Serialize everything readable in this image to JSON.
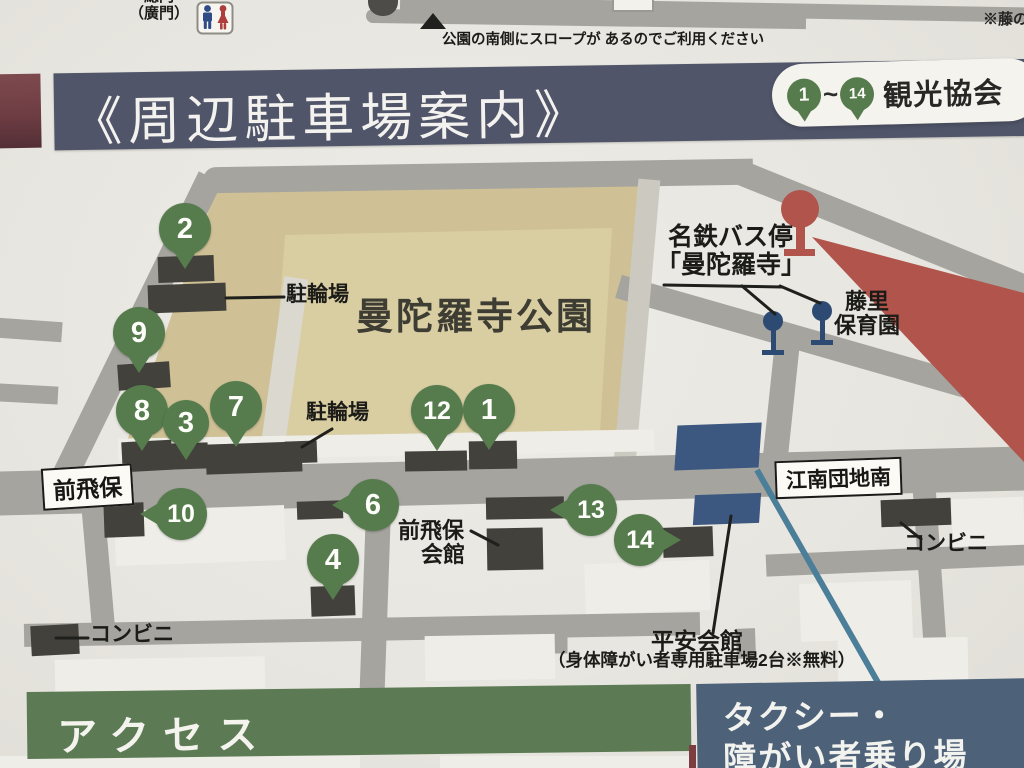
{
  "top": {
    "gate_line1": "総門",
    "gate_line2": "（廣門）",
    "slope_note": "公園の南側にスロープが あるのでご利用ください",
    "corner_note": "※藤の"
  },
  "header": {
    "title": "《周辺駐車場案内》",
    "band_color": "#505569",
    "accent_stripe_color": "#6e3d43",
    "legend": {
      "from": "1",
      "tilde": "~",
      "to": "14",
      "label": "観光協会"
    }
  },
  "colors": {
    "road": "#a5a49f",
    "park_outer": "#cfc195",
    "park_inner": "#d9cda2",
    "parking_lot": "#42413b",
    "pin_green": "#567c4e",
    "bus_stop_blue": "#2c4a72",
    "heian_blue": "#3c5880",
    "marker_red": "#b0544c",
    "water_line": "#4b7e98"
  },
  "map": {
    "park_name": "曼陀羅寺公園",
    "park_shape": {
      "outer": [
        [
          216,
          190
        ],
        [
          650,
          182
        ],
        [
          634,
          440
        ],
        [
          126,
          444
        ]
      ],
      "inner": [
        [
          285,
          235
        ],
        [
          612,
          228
        ],
        [
          600,
          432
        ],
        [
          270,
          436
        ]
      ]
    },
    "roads": [
      {
        "cx": 713,
        "cy": 9,
        "l": 626,
        "w": 15,
        "a": 1
      },
      {
        "cx": 586,
        "cy": 19,
        "l": 440,
        "w": 14,
        "a": 0.8,
        "cap": 1
      },
      {
        "cx": 478,
        "cy": 176,
        "l": 550,
        "w": 26,
        "a": -0.9,
        "cap": 1
      },
      {
        "cx": 886,
        "cy": 231,
        "l": 315,
        "w": 25,
        "a": 22
      },
      {
        "cx": 830,
        "cy": 347,
        "l": 440,
        "w": 24,
        "a": 16
      },
      {
        "cx": 637,
        "cy": 321,
        "l": 284,
        "w": 22,
        "a": 95,
        "c": "#ccc9c1"
      },
      {
        "cx": 132,
        "cy": 338,
        "l": 358,
        "w": 26,
        "a": 116
      },
      {
        "cx": 30,
        "cy": 330,
        "l": 64,
        "w": 20,
        "a": 4
      },
      {
        "cx": 28,
        "cy": 394,
        "l": 60,
        "w": 18,
        "a": 3
      },
      {
        "cx": 512,
        "cy": 481,
        "l": 1060,
        "w": 44,
        "a": -1.4
      },
      {
        "cx": 781,
        "cy": 403,
        "l": 128,
        "w": 25,
        "a": 96
      },
      {
        "cx": 98,
        "cy": 570,
        "l": 141,
        "w": 23,
        "a": 85
      },
      {
        "cx": 376,
        "cy": 580,
        "l": 216,
        "w": 25,
        "a": 92
      },
      {
        "cx": 930,
        "cy": 579,
        "l": 223,
        "w": 23,
        "a": 86
      },
      {
        "cx": 362,
        "cy": 629,
        "l": 676,
        "w": 23,
        "a": -1
      },
      {
        "cx": 896,
        "cy": 560,
        "l": 260,
        "w": 22,
        "a": -2.5
      },
      {
        "cx": 558,
        "cy": 640,
        "l": 26,
        "w": 19,
        "a": 90
      },
      {
        "cx": 746,
        "cy": 643,
        "l": 30,
        "w": 19,
        "a": 88
      },
      {
        "cx": 283,
        "cy": 373,
        "l": 192,
        "w": 24,
        "a": 98,
        "c": "#dbd8d0"
      }
    ],
    "blocks": [
      [
        115,
        508,
        170,
        55,
        -2
      ],
      [
        585,
        562,
        125,
        50,
        -2
      ],
      [
        800,
        582,
        112,
        58,
        -2
      ],
      [
        952,
        498,
        72,
        48,
        -2
      ],
      [
        838,
        638,
        130,
        45,
        -1
      ],
      [
        425,
        635,
        130,
        45,
        -1
      ],
      [
        55,
        658,
        210,
        32,
        -1
      ],
      [
        118,
        434,
        536,
        22,
        -1
      ],
      [
        0,
        756,
        360,
        12,
        0
      ],
      [
        440,
        756,
        250,
        12,
        0
      ]
    ],
    "parking_rects": [
      [
        158,
        256,
        56,
        26,
        -2
      ],
      [
        148,
        284,
        78,
        28,
        -2
      ],
      [
        118,
        363,
        52,
        26,
        -4
      ],
      [
        122,
        441,
        50,
        30,
        -3
      ],
      [
        170,
        443,
        38,
        26,
        -2
      ],
      [
        206,
        443,
        96,
        30,
        -2
      ],
      [
        285,
        441,
        32,
        22,
        -2
      ],
      [
        405,
        451,
        62,
        20,
        -1
      ],
      [
        469,
        441,
        48,
        28,
        -1
      ],
      [
        104,
        503,
        40,
        34,
        -2
      ],
      [
        297,
        501,
        46,
        18,
        -2
      ],
      [
        311,
        586,
        44,
        30,
        -2
      ],
      [
        486,
        497,
        78,
        22,
        -1
      ],
      [
        487,
        528,
        56,
        42,
        -1
      ],
      [
        663,
        527,
        50,
        30,
        -2
      ],
      [
        881,
        499,
        70,
        27,
        -2
      ],
      [
        31,
        625,
        48,
        30,
        -3
      ]
    ],
    "heian_blocks": [
      [
        676,
        424,
        84,
        45
      ],
      [
        694,
        494,
        66,
        30
      ]
    ],
    "water_line": [
      757,
      470,
      888,
      700
    ],
    "red_wedge": [
      [
        812,
        237
      ],
      [
        1024,
        293
      ],
      [
        1024,
        462
      ]
    ],
    "red_marker": {
      "x": 800,
      "y": 209
    },
    "bus_stops": [
      [
        773,
        321
      ],
      [
        822,
        311
      ]
    ],
    "leader_lines": [
      [
        226,
        298,
        284,
        297
      ],
      [
        332,
        429,
        302,
        447
      ],
      [
        664,
        285,
        782,
        287
      ],
      [
        742,
        286,
        775,
        314
      ],
      [
        780,
        286,
        820,
        303
      ],
      [
        471,
        531,
        498,
        545
      ],
      [
        901,
        523,
        921,
        539
      ],
      [
        56,
        638,
        88,
        638
      ],
      [
        731,
        516,
        713,
        633
      ]
    ],
    "labels": [
      {
        "t": "駐輪場",
        "x": 286,
        "y": 284,
        "fs": 21
      },
      {
        "t": "駐輪場",
        "x": 306,
        "y": 402,
        "fs": 21
      },
      {
        "t": "名鉄バス停",
        "x": 668,
        "y": 224,
        "fs": 25
      },
      {
        "t": "「曼陀羅寺」",
        "x": 656,
        "y": 252,
        "fs": 25
      },
      {
        "t": "藤里",
        "x": 845,
        "y": 290,
        "fs": 22
      },
      {
        "t": "保育園",
        "x": 834,
        "y": 314,
        "fs": 22
      },
      {
        "t": "前飛保",
        "x": 398,
        "y": 519,
        "fs": 22
      },
      {
        "t": "会館",
        "x": 421,
        "y": 543,
        "fs": 22
      },
      {
        "t": "コンビニ",
        "x": 904,
        "y": 533,
        "fs": 21
      },
      {
        "t": "コンビニ",
        "x": 90,
        "y": 624,
        "fs": 21
      },
      {
        "t": "曼陀羅寺公園",
        "x": 356,
        "y": 298,
        "fs": 37,
        "ls": 3,
        "c": "#3e3d33"
      },
      {
        "t": "平安会館",
        "x": 651,
        "y": 629,
        "fs": 23
      },
      {
        "t": "（身体障がい者専用駐車場2台※無料）",
        "x": 548,
        "y": 651,
        "fs": 17.5
      }
    ],
    "intersections": [
      {
        "t": "前飛保",
        "x": 42,
        "y": 466,
        "fs": 23,
        "a": -3.5
      },
      {
        "t": "江南団地南",
        "x": 775,
        "y": 459,
        "fs": 21,
        "a": -2
      }
    ],
    "pins": [
      {
        "n": "2",
        "x": 185,
        "y": 229
      },
      {
        "n": "9",
        "x": 139,
        "y": 333
      },
      {
        "n": "8",
        "x": 142,
        "y": 411
      },
      {
        "n": "3",
        "x": 186,
        "y": 423,
        "r": 23
      },
      {
        "n": "7",
        "x": 236,
        "y": 407
      },
      {
        "n": "12",
        "x": 437,
        "y": 411
      },
      {
        "n": "1",
        "x": 489,
        "y": 410
      },
      {
        "n": "10",
        "x": 181,
        "y": 514,
        "d": "left"
      },
      {
        "n": "6",
        "x": 373,
        "y": 505,
        "d": "left"
      },
      {
        "n": "4",
        "x": 333,
        "y": 560
      },
      {
        "n": "13",
        "x": 591,
        "y": 510,
        "d": "left"
      },
      {
        "n": "14",
        "x": 640,
        "y": 540,
        "d": "right"
      }
    ]
  },
  "footer": {
    "access_title": "アクセス",
    "taxi_line1": "タクシー・",
    "taxi_line2": "障がい者乗り場"
  }
}
